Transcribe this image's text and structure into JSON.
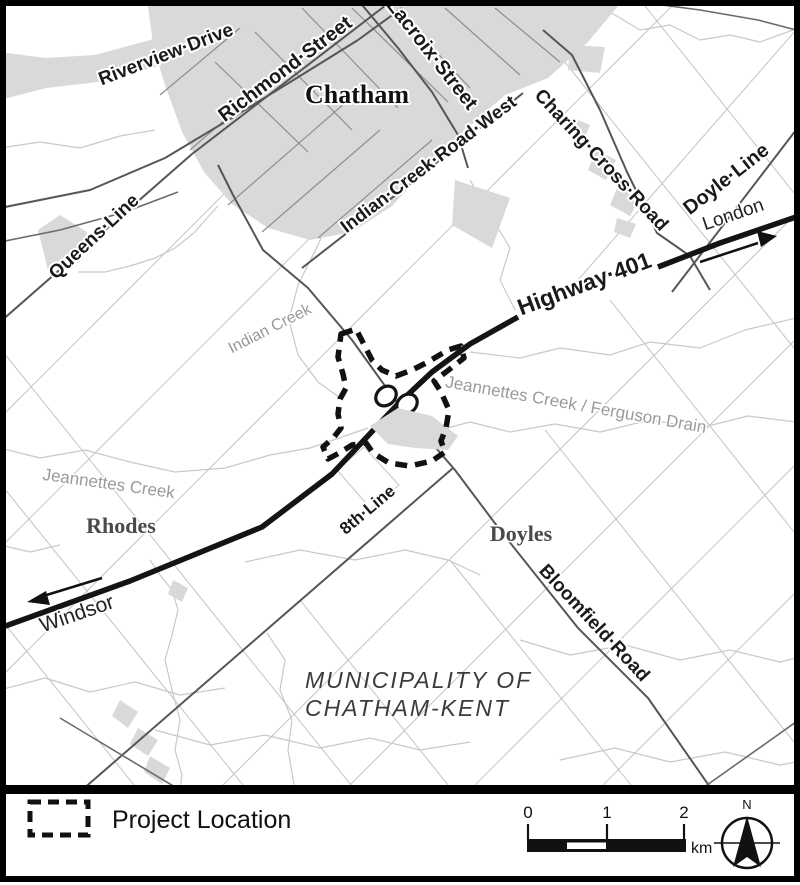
{
  "map": {
    "places": {
      "chatham": "Chatham",
      "rhodes": "Rhodes",
      "doyles": "Doyles"
    },
    "municipality_line1": "MUNICIPALITY OF",
    "municipality_line2": "CHATHAM-KENT",
    "roads": {
      "riverview": "Riverview·Drive",
      "richmond": "Richmond·Street",
      "lacroix": "Lacroix·Street",
      "indian_creek_road": "Indian·Creek·Road·West",
      "charing_cross": "Charing·Cross·Road",
      "doyle_line": "Doyle·Line",
      "queens_line": "Queens·Line",
      "highway_401": "Highway·401",
      "eighth_line": "8th·Line",
      "bloomfield": "Bloomfield·Road"
    },
    "waterways": {
      "indian_creek": "Indian Creek",
      "jeannettes_ferguson": "Jeannettes Creek / Ferguson Drain",
      "jeannettes": "Jeannettes Creek"
    },
    "directions": {
      "london": "London",
      "windsor": "Windsor"
    }
  },
  "legend": {
    "project_location": "Project Location",
    "scale": {
      "tick0": "0",
      "tick1": "1",
      "tick2": "2",
      "unit": "km"
    },
    "north": "N"
  },
  "colors": {
    "urban_fill": "#d9d9d9",
    "highway": "#141414",
    "road_dark": "#565656",
    "lot_line": "#c3c3c3",
    "creek": "#c9c9c9",
    "water_label": "#9a9a9a",
    "place_label": "#4a4a4a",
    "boundary": "#111111"
  }
}
